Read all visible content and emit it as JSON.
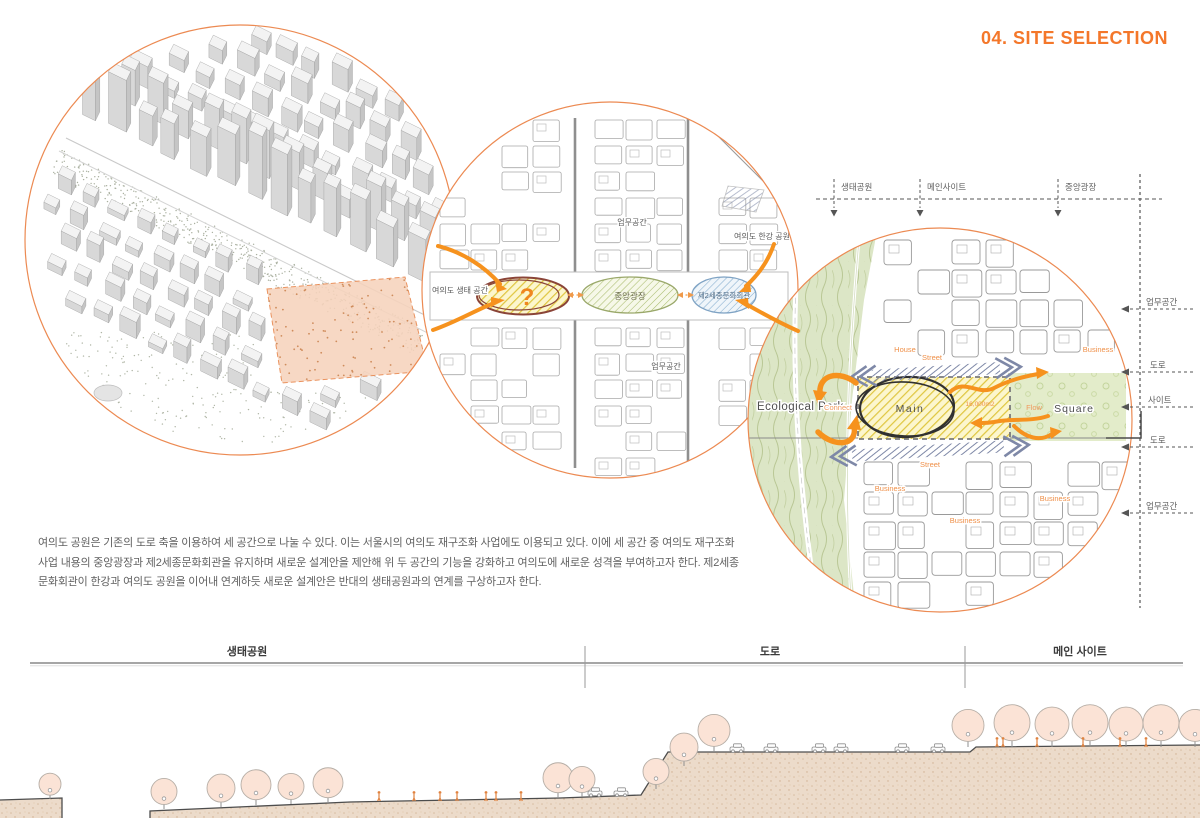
{
  "title": "04. SITE SELECTION",
  "description": "여의도 공원은 기존의 도로 축을 이용하여 세 공간으로 나눌 수 있다. 이는 서울시의 여의도 재구조화 사업에도 이용되고 있다. 이에 세 공간 중 여의도 재구조화 사업 내용의 중앙광장과 제2세종문화회관을 유지하며 새로운 설계안을 제안해 위 두 공간의 기능을 강화하고 여의도에 새로운 성격을 부여하고자 한다. 제2세종문화회관이 한강과 여의도 공원을 이어내 연계하듯 새로운 설계안은 반대의 생태공원과의 연계를 구상하고자 한다.",
  "colors": {
    "accent": "#f4772a",
    "arrow_orange": "#f6921e",
    "park_green": "#dce6c6",
    "site_yellow": "#fcf6cd",
    "street_blue": "#7e88a7",
    "ground_beige": "#ecdbca",
    "site_peach": "#f6d3bc"
  },
  "plan_circle": {
    "left_label": "여의도 생태 공간",
    "top_label": "업무공간",
    "bottom_label": "업무공간",
    "hangang_label": "여의도 한강 공원",
    "question_mark": "?",
    "central_plaza": "중앙광장",
    "sejong_hall": "제2세종문화회관"
  },
  "site_circle": {
    "ecological_park": "Ecological Park",
    "connect": "Connect",
    "main": "Main",
    "area": "16,000m2",
    "flow": "Flow",
    "square": "Square",
    "street_top": "Street",
    "street_bottom": "Street",
    "house": "House",
    "business": [
      "Business",
      "Business",
      "Business",
      "Business"
    ]
  },
  "top_axis": {
    "labels": [
      "생태공원",
      "메인사이트",
      "중앙광장"
    ]
  },
  "right_axis": {
    "labels": [
      "업무공간",
      "도로",
      "사이트",
      "도로",
      "업무공간"
    ]
  },
  "section": {
    "labels": [
      "생태공원",
      "도로",
      "메인 사이트"
    ]
  }
}
